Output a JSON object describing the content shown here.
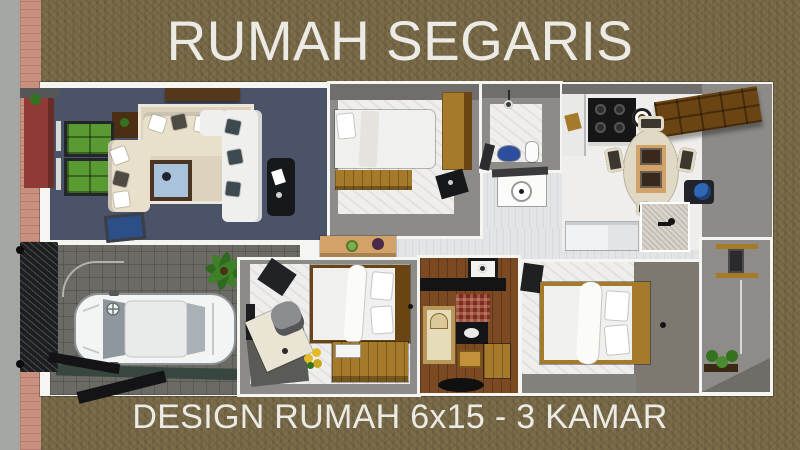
{
  "header": {
    "title": "RUMAH SEGARIS"
  },
  "footer": {
    "caption": "DESIGN RUMAH 6x15 - 3 KAMAR"
  },
  "palette": {
    "bg_olive": "#796a48",
    "text_light": "#eceae5",
    "street_gray": "#a3a6a3",
    "brick_pink": "#c9907f",
    "brick_mortar": "#b57c6d",
    "plan_white": "#f5f5f2",
    "living_navy": "#4a5367",
    "rug_cream": "#ddd3bd",
    "sofa_beige": "#e9e0cb",
    "sofa_white": "#efefed",
    "pillow_dark": "#4e4a44",
    "table_wood_dark": "#4b3421",
    "table_blue": "#a9c3dc",
    "shelf_green": "#5a9a33",
    "black": "#17181a",
    "wood_mid": "#a67a2b",
    "wood_dark": "#6b4413",
    "wall_gray": "#8c8b88",
    "wall_gray_dark": "#6f6e6b",
    "floor_white": "#efeeec",
    "floor_tile": "#e3e4e5",
    "bed_white": "#f0f0ee",
    "carport_gray": "#6b6a64",
    "car_white": "#f3f4f4",
    "car_glass": "#8e969e",
    "plant_green": "#35721f",
    "gate_black": "#1d1e20",
    "fence_red": "#8e3b35",
    "stove_black": "#161616",
    "counter_white": "#e9e9e7",
    "dining_cream": "#e0d9c5",
    "runner_tan": "#d2a268",
    "mat_dark": "#39291c",
    "dispenser_blue": "#2f66b5",
    "island_speck": "#d7d3ca",
    "fridge_white": "#f1f2f3",
    "taupe_wall": "#7e7970",
    "prayer_wood": "#7c4a22",
    "prayer_rug": "#e7dcba",
    "prayer_red": "#7e2c20",
    "gold": "#c2913c",
    "desk_cream": "#eae4d4",
    "chair_gray": "#8a8c8e",
    "sun_yellow": "#e2bd2a",
    "service_gray": "#8d8c88",
    "toilet_blue": "#2d4d9e"
  }
}
